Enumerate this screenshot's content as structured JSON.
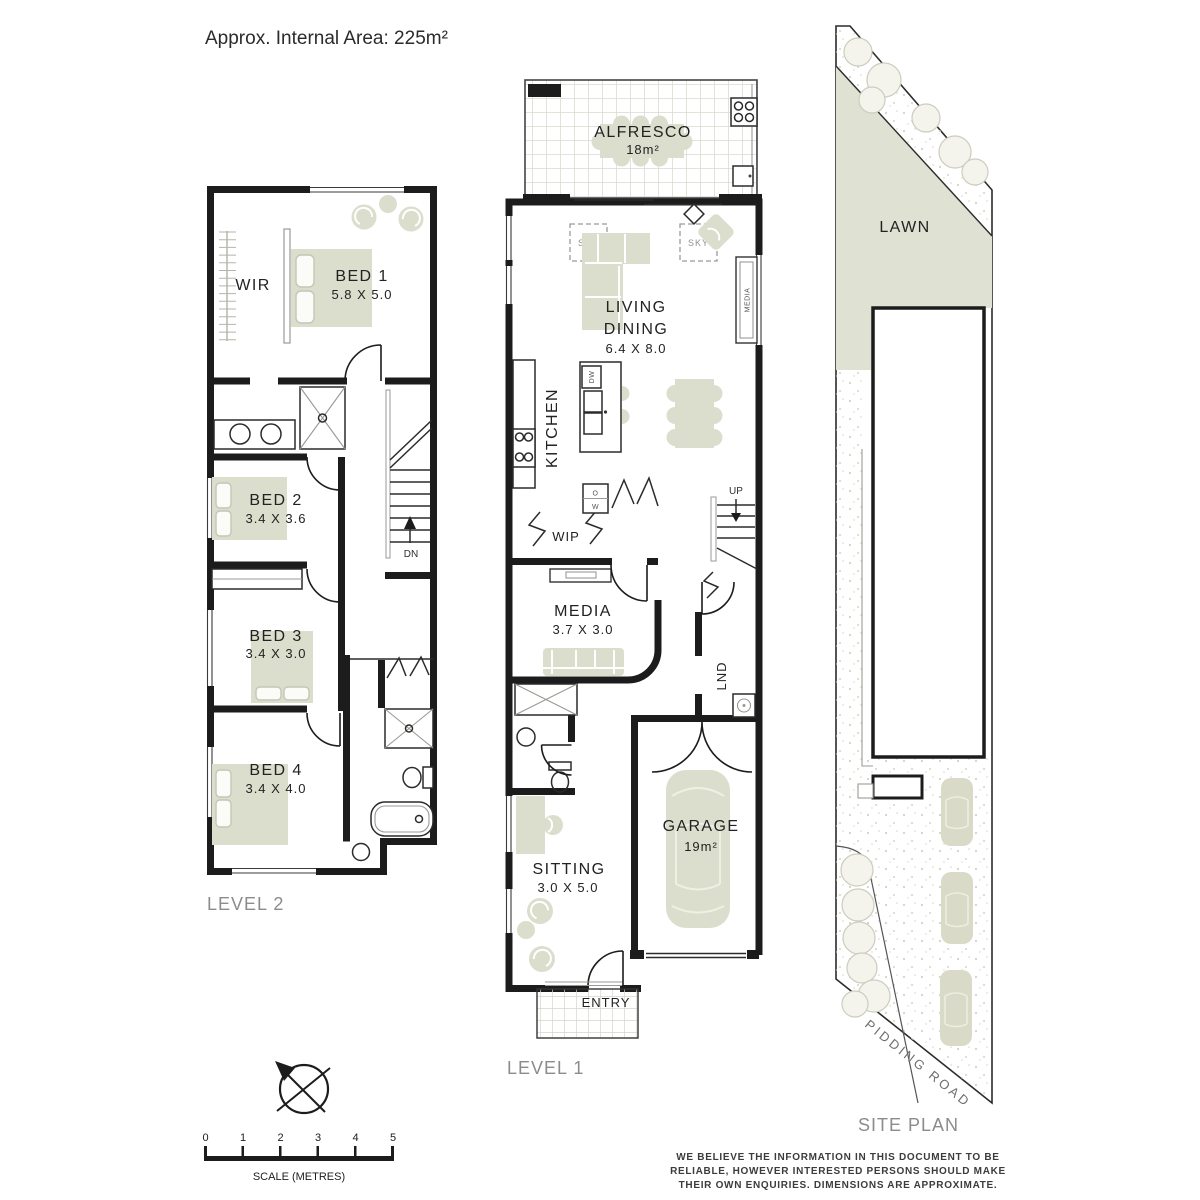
{
  "header": {
    "title": "Approx. Internal Area: 225m²"
  },
  "level2": {
    "label": "LEVEL 2",
    "rooms": {
      "wir": {
        "name": "WIR"
      },
      "bed1": {
        "name": "BED 1",
        "dims": "5.8 X 5.0"
      },
      "bed2": {
        "name": "BED 2",
        "dims": "3.4 X 3.6"
      },
      "bed3": {
        "name": "BED 3",
        "dims": "3.4 X 3.0"
      },
      "bed4": {
        "name": "BED 4",
        "dims": "3.4 X 4.0"
      }
    },
    "stairs": {
      "direction": "DN"
    }
  },
  "level1": {
    "label": "LEVEL 1",
    "rooms": {
      "alfresco": {
        "name": "ALFRESCO",
        "area": "18m²"
      },
      "living_dining": {
        "name_line1": "LIVING",
        "name_line2": "DINING",
        "dims": "6.4 X 8.0"
      },
      "kitchen": {
        "name": "KITCHEN"
      },
      "wip": {
        "name": "WIP"
      },
      "media": {
        "name": "MEDIA",
        "dims": "3.7 X 3.0"
      },
      "laundry": {
        "name": "LND"
      },
      "sitting": {
        "name": "SITTING",
        "dims": "3.0 X 5.0"
      },
      "garage": {
        "name": "GARAGE",
        "area": "19m²"
      },
      "entry": {
        "name": "ENTRY"
      }
    },
    "stairs": {
      "direction": "UP"
    },
    "annotations": {
      "skylight": "SKY",
      "media_unit": "MEDIA",
      "dishwasher": "DW",
      "oven": "O",
      "wall_oven": "W"
    }
  },
  "site_plan": {
    "label": "SITE PLAN",
    "lawn": "LAWN",
    "road": "PIDDING ROAD"
  },
  "scale_bar": {
    "ticks": [
      "0",
      "1",
      "2",
      "3",
      "4",
      "5"
    ],
    "label": "SCALE (METRES)"
  },
  "disclaimer": {
    "line1": "WE BELIEVE THE INFORMATION IN THIS DOCUMENT TO BE",
    "line2": "RELIABLE, HOWEVER INTERESTED PERSONS SHOULD MAKE",
    "line3": "THEIR OWN ENQUIRIES. DIMENSIONS ARE APPROXIMATE."
  },
  "colors": {
    "wall": "#1c1c1c",
    "furniture": "#dcdecd",
    "lawn": "#dfe2d3",
    "label_gray": "#8c8c8c"
  }
}
